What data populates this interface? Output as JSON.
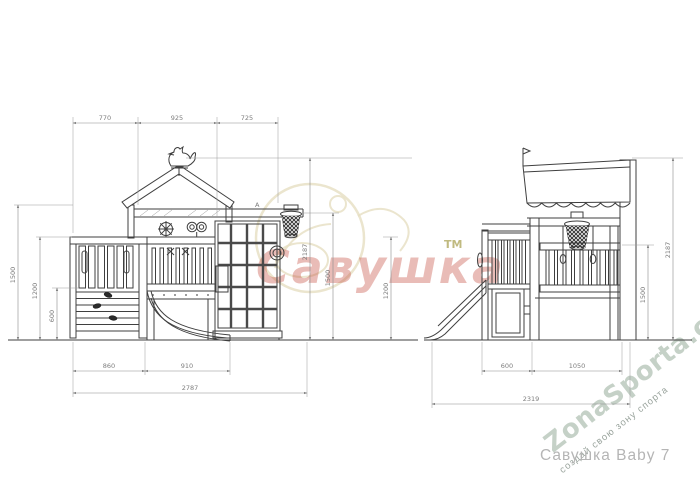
{
  "front_view": {
    "label": "front elevation of playground",
    "dim_top": [
      "770",
      "925",
      "725"
    ],
    "dim_left": [
      "1500",
      "1200",
      "600"
    ],
    "dim_right": [
      "2187",
      "1500",
      "1200"
    ],
    "dim_bottom": [
      "860",
      "910"
    ],
    "dim_overall": "2787",
    "marker_a": "A"
  },
  "side_view": {
    "label": "side elevation of playground",
    "dim_right": [
      "2187",
      "1500"
    ],
    "dim_bottom": [
      "600",
      "1050"
    ],
    "dim_overall": "2319"
  },
  "watermarks": {
    "brand": {
      "text": "Савушка",
      "tm": "ТМ",
      "color": "#c4483a"
    },
    "site": {
      "text": "ZonaSporta.com",
      "slogan": "создай свою зону спорта",
      "color": "#c5d1c7",
      "slogan_color": "#9aa49d"
    },
    "caption": {
      "text": "Савушка  Baby  7",
      "color": "#b5b5b5"
    }
  }
}
